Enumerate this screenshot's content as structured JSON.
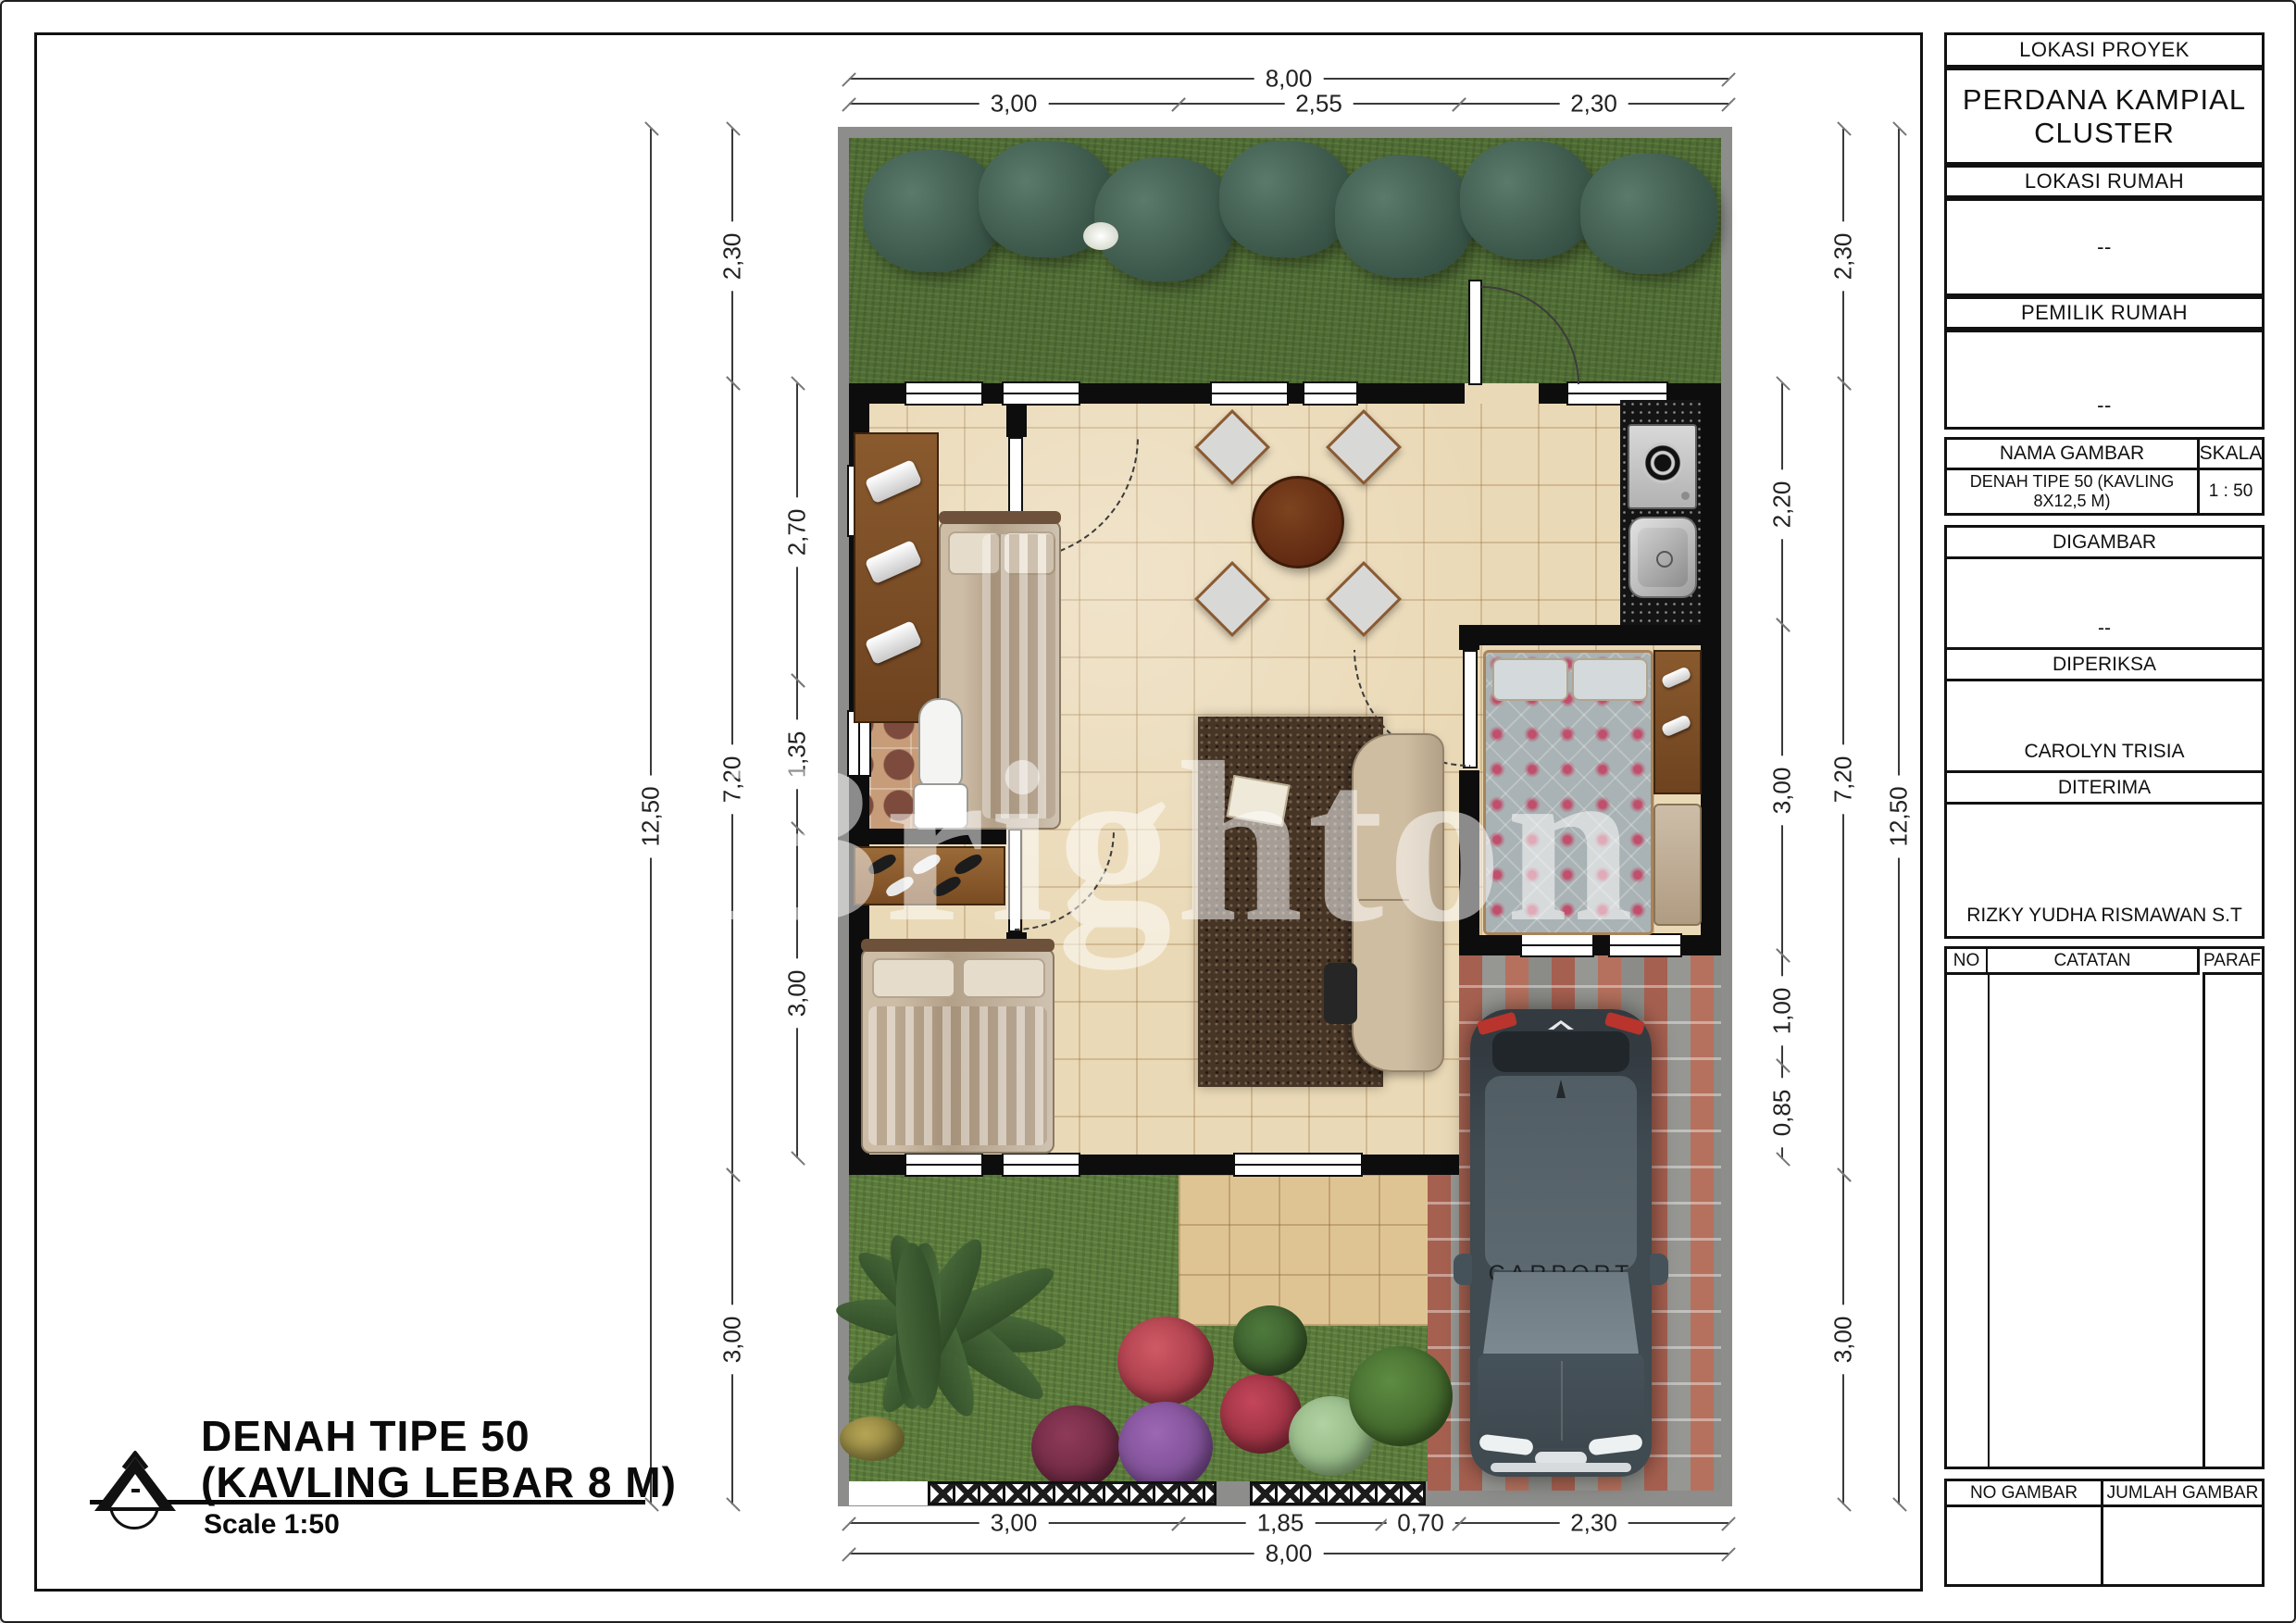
{
  "title_block": {
    "lokasi_proyek_label": "LOKASI PROYEK",
    "lokasi_proyek_value": "PERDANA KAMPIAL CLUSTER",
    "lokasi_rumah_label": "LOKASI RUMAH",
    "lokasi_rumah_value": "--",
    "pemilik_rumah_label": "PEMILIK RUMAH",
    "pemilik_rumah_value": "--",
    "nama_gambar_label": "NAMA GAMBAR",
    "nama_gambar_value": "DENAH TIPE 50 (KAVLING 8X12,5 M)",
    "skala_label": "SKALA",
    "skala_value": "1 : 50",
    "digambar_label": "DIGAMBAR",
    "digambar_value": "--",
    "diperiksa_label": "DIPERIKSA",
    "diperiksa_value": "CAROLYN TRISIA",
    "diterima_label": "DITERIMA",
    "diterima_value": "RIZKY YUDHA RISMAWAN S.T",
    "catatan_table": {
      "no_label": "NO",
      "catatan_label": "CATATAN",
      "paraf_label": "PARAF"
    },
    "footer": {
      "no_gambar_label": "NO GAMBAR",
      "jumlah_gambar_label": "JUMLAH GAMBAR",
      "no_gambar_value": "",
      "jumlah_gambar_value": ""
    }
  },
  "drawing_title": {
    "line1": "DENAH TIPE 50",
    "line2": "(KAVLING LEBAR 8 M)",
    "scale": "Scale 1:50"
  },
  "watermark": "Brighton",
  "plan": {
    "carport_label": "CARPORT",
    "dims": {
      "top_total": "8,00",
      "top_segments": [
        "3,00",
        "2,55",
        "2,30"
      ],
      "bottom_segments": [
        "3,00",
        "1,85",
        "0,70",
        "2,30"
      ],
      "bottom_total": "8,00",
      "left_total": "12,50",
      "left_outer": [
        "2,30",
        "7,20",
        "3,00"
      ],
      "left_inner": [
        "2,70",
        "1,35",
        "3,00"
      ],
      "right_inner": [
        "2,20",
        "3,00",
        "1,00",
        "0,85"
      ],
      "right_outer": [
        "2,30",
        "7,20",
        "3,00"
      ],
      "right_total": "12,50"
    }
  },
  "colors": {
    "paper": "#ffffff",
    "line": "#111111",
    "sidewalk_band": "#8d8d8b",
    "grass_top": "#4f6c35",
    "grass_bottom": "#5a7a3c",
    "floor_tile": "#ead9b6",
    "terrace_tile": "#dfc493",
    "bath_tile": "#c79c79",
    "brick_red": "#a85846",
    "granite": "#141414",
    "car_body": "#3f4a51",
    "car_accent_red": "#b8342c",
    "watermark_white": "rgba(255,255,255,0.52)"
  }
}
